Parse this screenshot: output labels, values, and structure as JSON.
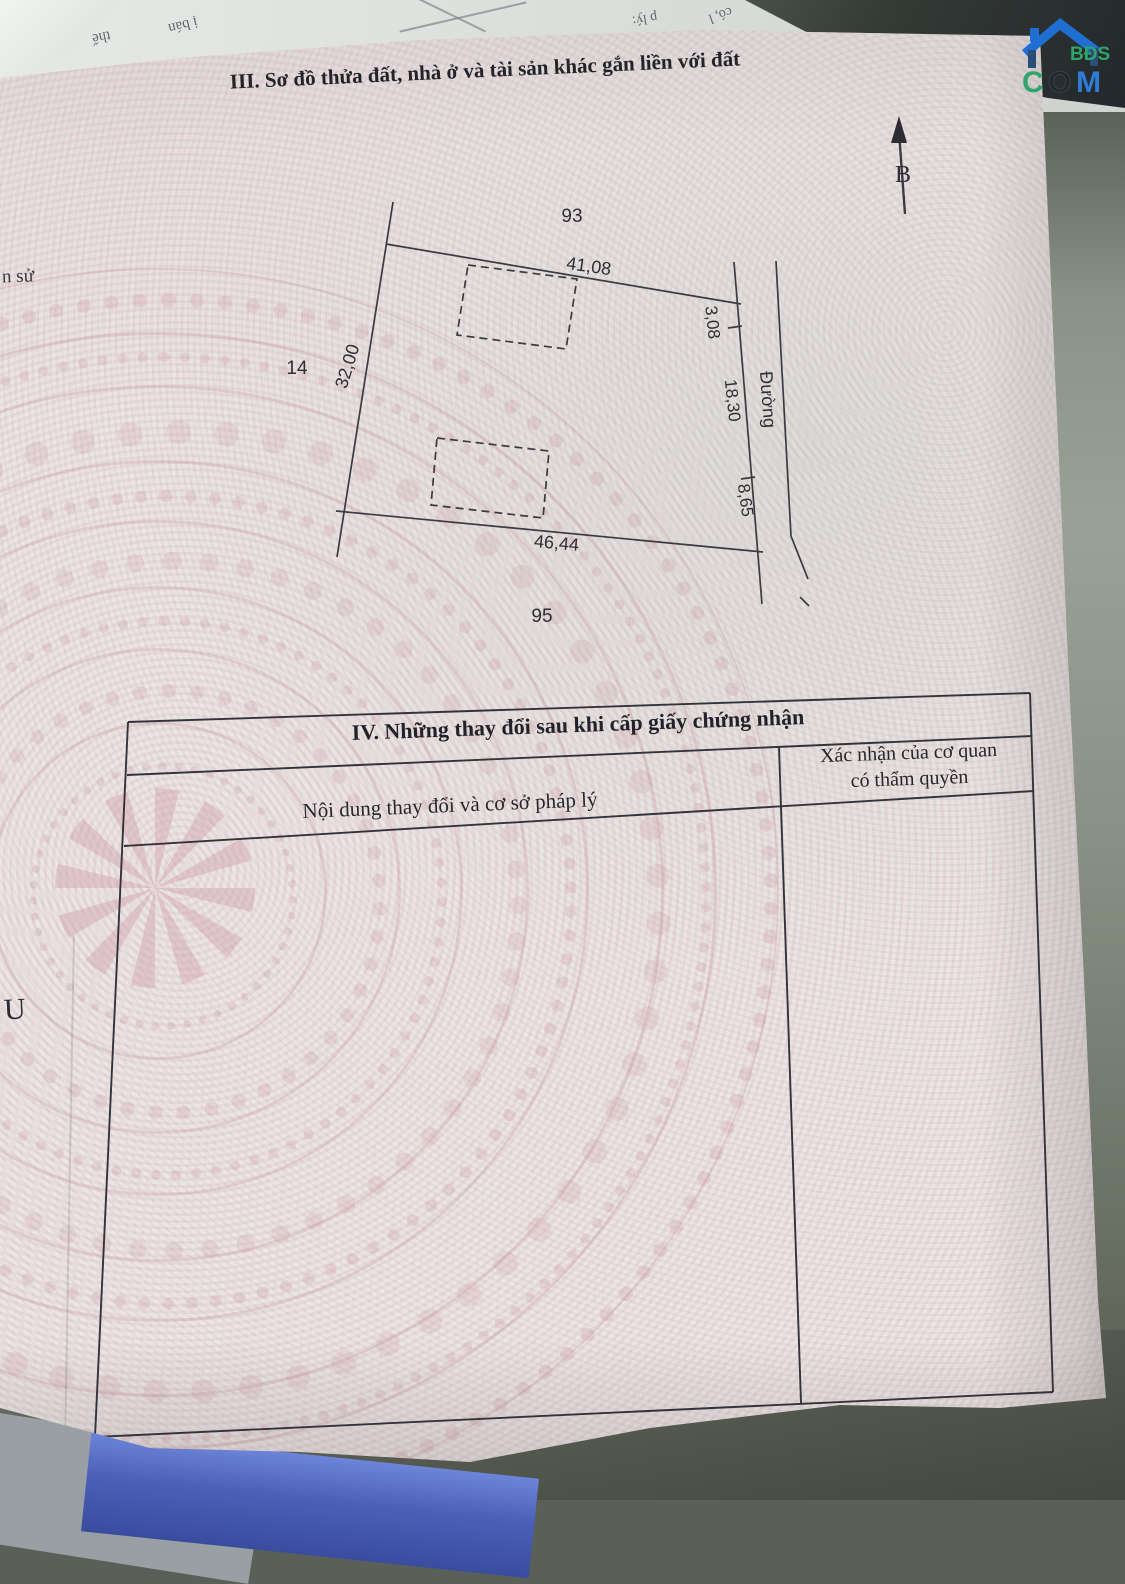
{
  "document": {
    "section3_title": "III. Sơ đồ thửa đất, nhà ở và tài sản khác gắn liền với đất",
    "section4": {
      "title": "IV. Những thay đổi sau khi cấp giấy chứng nhận",
      "col1_header": "Nội dung thay đổi và cơ sở pháp lý",
      "col2_header_line1": "Xác nhận của cơ quan",
      "col2_header_line2": "có thẩm quyền"
    },
    "diagram": {
      "north_label": "B",
      "neighbor_parcels": {
        "top": "93",
        "left": "14",
        "bottom": "95"
      },
      "edge_lengths": {
        "top": "41,08",
        "left": "32,00",
        "bottom": "46,44"
      },
      "right_segments": [
        "3,08",
        "18,30",
        "8,65"
      ],
      "road_label": "Đường"
    },
    "page_fragments": {
      "left_mid": "n sử",
      "left_lower": "U"
    }
  },
  "background_papers": {
    "fragments": [
      "thế",
      "ị bán",
      "p lý:",
      "có, l"
    ]
  },
  "watermark": {
    "bds": "BĐS",
    "c": "C",
    "o": "O",
    "m": "M",
    "house_color": "#1f6fd2",
    "bds_color": "#2fa56b",
    "o_color": "#23282c",
    "m_color": "#2e7cd6"
  }
}
